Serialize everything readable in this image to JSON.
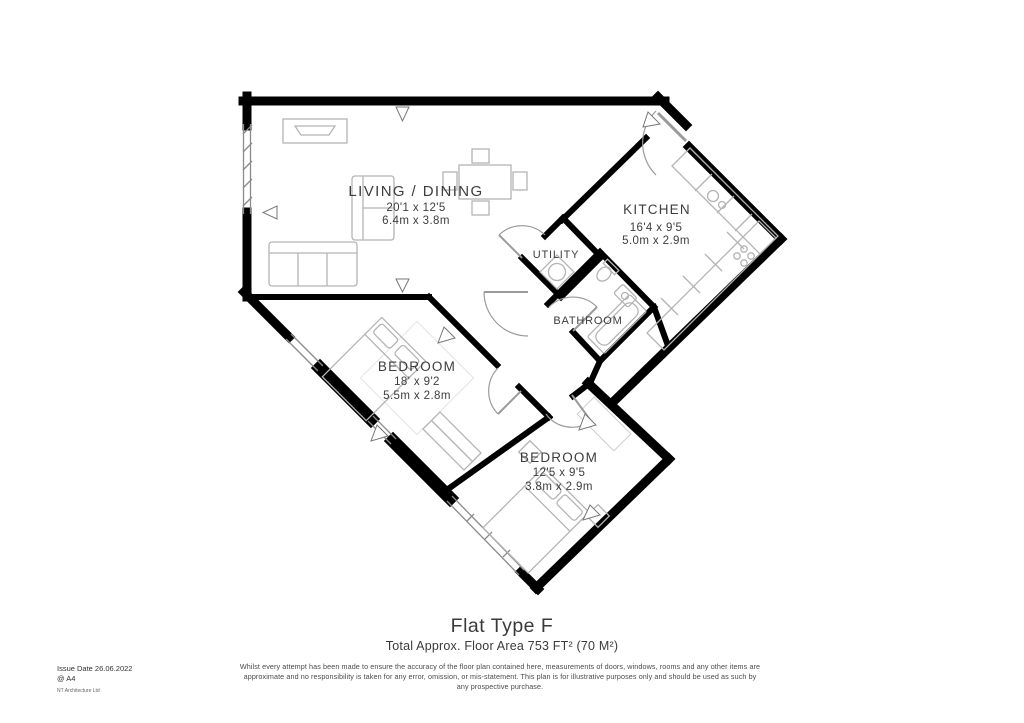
{
  "floorplan": {
    "rooms": [
      {
        "name": "LIVING / DINING",
        "dim_imperial": "20'1 x 12'5",
        "dim_metric": "6.4m x 3.8m"
      },
      {
        "name": "KITCHEN",
        "dim_imperial": "16'4 x 9'5",
        "dim_metric": "5.0m x 2.9m"
      },
      {
        "name": "UTILITY"
      },
      {
        "name": "BATHROOM"
      },
      {
        "name": "BEDROOM",
        "dim_imperial": "18' x 9'2",
        "dim_metric": "5.5m x 2.8m"
      },
      {
        "name": "BEDROOM",
        "dim_imperial": "12'5 x 9'5",
        "dim_metric": "3.8m x 2.9m"
      }
    ]
  },
  "title_block": {
    "title": "Flat Type F",
    "subtitle": "Total Approx. Floor Area 753 FT² (70 M²)"
  },
  "footer": {
    "issue_date": "Issue Date 26.06.2022",
    "paper_size": "@ A4",
    "company": "NT Architecture Ltd",
    "disclaimer": [
      "Whilst every attempt has been made to ensure the accuracy of the floor plan contained here, measurements of doors, windows, rooms and any other items are",
      "approximate and no responsibility is taken for any error, omission, or mis-statement. This plan is for illustrative purposes only and should be used as such by",
      "any prospective purchase."
    ]
  },
  "colors": {
    "wall": "#000000",
    "fixture": "#b4b4b4",
    "window_line": "#8a8a8a",
    "label_text": "#3d3d3d",
    "background": "#ffffff"
  }
}
